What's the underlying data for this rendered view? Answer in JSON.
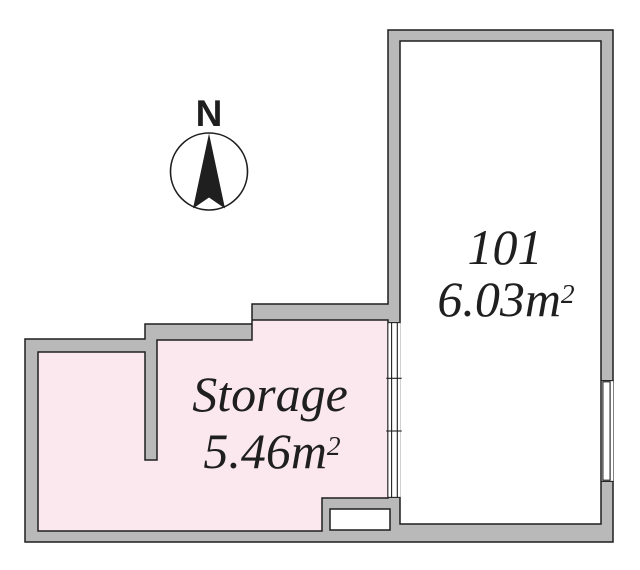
{
  "compass": {
    "north_label": "N"
  },
  "rooms": [
    {
      "name": "101",
      "area_value": "6.03m",
      "area_sup": "2"
    },
    {
      "name": "Storage",
      "area_value": "5.46m",
      "area_sup": "2"
    }
  ],
  "colors": {
    "background": "#ffffff",
    "wall_fill": "#b9b9b9",
    "outline": "#1f1f1f",
    "storage_fill": "#fae8ee",
    "text": "#1f1f1f"
  }
}
